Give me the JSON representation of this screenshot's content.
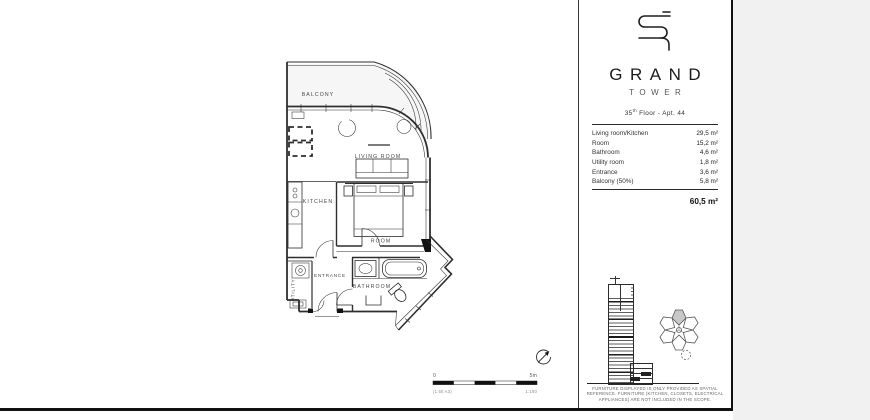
{
  "colors": {
    "page_bg": "#ffffff",
    "outside_bg": "#f1f1f1",
    "line": "#2e2e2e",
    "highlight_fill": "#c8c8c8"
  },
  "floorplan": {
    "rooms": {
      "balcony": "BALCONY",
      "living": "LIVING ROOM",
      "kitchen": "KITCHEN",
      "room": "ROOM",
      "entrance": "ENTRANCE",
      "bathroom": "BATHROOM",
      "utility": "UTILITY"
    },
    "scale": {
      "start": "0",
      "end": "5m",
      "note_left": "(1:50 A3)",
      "note_right": "1:100"
    }
  },
  "panel": {
    "brand": "GRAND",
    "brand_sub": "TOWER",
    "unit": {
      "floor_num": "35",
      "floor_sup": "th",
      "rest": " Floor - Apt. 44"
    },
    "areas": [
      {
        "label": "Living room/Kitchen",
        "value": "29,5 m²"
      },
      {
        "label": "Room",
        "value": "15,2 m²"
      },
      {
        "label": "Bathroom",
        "value": "4,6 m²"
      },
      {
        "label": "Utility room",
        "value": "1,8 m²"
      },
      {
        "label": "Entrance",
        "value": "3,6 m²"
      },
      {
        "label": "Balcony (50%)",
        "value": "5,8 m²"
      }
    ],
    "total": "60,5 m²",
    "disclaimer": [
      "FURNITURE DISPLAYED IS ONLY PROVIDED AS SPATIAL",
      "REFERENCE. FURNITURE (KITCHEN, CLOSETS, ELECTRICAL",
      "APPLIANCES) ARE NOT INCLUDED IN THE SCOPE."
    ]
  }
}
